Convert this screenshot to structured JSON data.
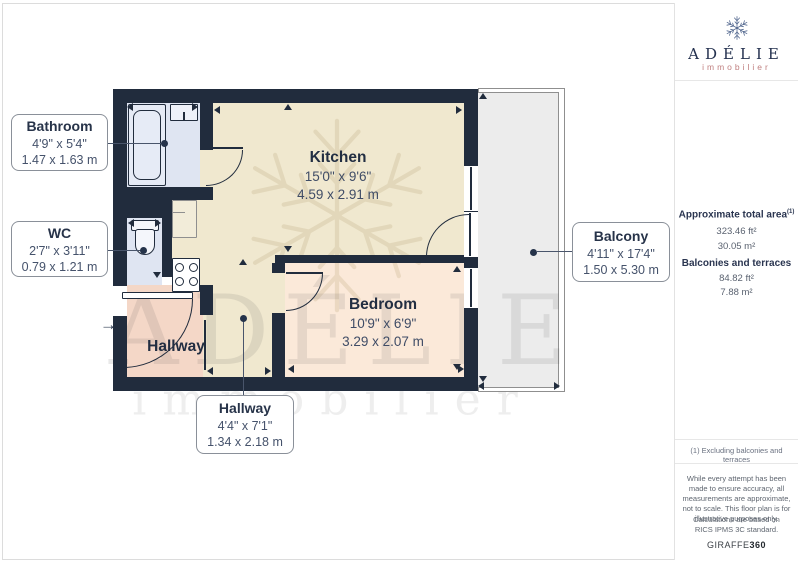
{
  "branding": {
    "name": "ADÉLIE",
    "tagline": "immobilier"
  },
  "sidebar": {
    "areas": {
      "title": "Approximate total area",
      "sup": "(1)",
      "values": [
        "323.46 ft²",
        "30.05 m²"
      ],
      "subtitle": "Balconies and terraces",
      "sub_values": [
        "84.82 ft²",
        "7.88 m²"
      ]
    },
    "footnote": "(1) Excluding balconies and terraces",
    "disclaimer1": "While every attempt has been made to ensure accuracy, all measurements are approximate, not to scale. This floor plan is for illustrative purposes only.",
    "disclaimer2": "Calculations are based on RICS IPMS 3C standard.",
    "brand_left": "GIRAFFE",
    "brand_right": "360"
  },
  "plan": {
    "watermark": {
      "title": "ADÉLIE",
      "subtitle": "immobilier"
    },
    "entry_arrow": {
      "glyph": "→",
      "x": 100,
      "y": 316
    },
    "colors": {
      "ink": "#212c3d",
      "kitchen": "#f0e8cf",
      "bedroom": "#fbe9d9",
      "hallway": "#f4d7c7",
      "bath": "#dfe5f2",
      "balcony": "#ececec",
      "leader": "#49556b"
    },
    "balcony": {
      "x": 478,
      "y": 88,
      "w": 87,
      "h": 304,
      "inset": 4
    },
    "floors": [
      {
        "id": "bathroom",
        "x": 127,
        "y": 103,
        "w": 73,
        "h": 84,
        "c": "bath"
      },
      {
        "id": "wc",
        "x": 127,
        "y": 218,
        "w": 35,
        "h": 67,
        "c": "bath"
      },
      {
        "id": "kitchen-main",
        "x": 213,
        "y": 103,
        "w": 251,
        "h": 152,
        "c": "kitchen"
      },
      {
        "id": "kitchen-side",
        "x": 172,
        "y": 200,
        "w": 41,
        "h": 93,
        "c": "kitchen"
      },
      {
        "id": "corridor",
        "x": 203,
        "y": 255,
        "w": 72,
        "h": 122,
        "c": "kitchen"
      },
      {
        "id": "hallway",
        "x": 127,
        "y": 285,
        "w": 76,
        "h": 92,
        "c": "hallway"
      },
      {
        "id": "bedroom",
        "x": 285,
        "y": 263,
        "w": 179,
        "h": 114,
        "c": "bedroom"
      }
    ],
    "walls": [
      [
        113,
        89,
        365,
        14
      ],
      [
        113,
        89,
        14,
        302
      ],
      [
        113,
        377,
        365,
        14
      ],
      [
        464,
        89,
        14,
        302
      ],
      [
        200,
        103,
        13,
        47
      ],
      [
        113,
        187,
        100,
        13
      ],
      [
        113,
        200,
        59,
        18
      ],
      [
        162,
        218,
        10,
        59
      ],
      [
        200,
        285,
        13,
        30
      ],
      [
        275,
        255,
        189,
        8
      ],
      [
        272,
        263,
        13,
        114
      ]
    ],
    "gaps": [
      {
        "id": "entry-opening",
        "x": 113,
        "y": 286,
        "w": 14,
        "h": 30,
        "c": "#ffffff"
      },
      {
        "id": "bathroom-door-opening",
        "x": 200,
        "y": 150,
        "w": 13,
        "h": 37,
        "c": "kitchen"
      },
      {
        "id": "bedroom-door-opening",
        "x": 272,
        "y": 273,
        "w": 13,
        "h": 40,
        "c": "kitchen"
      },
      {
        "id": "kitchen-window",
        "x": 464,
        "y": 166,
        "w": 14,
        "h": 45,
        "c": "#ffffff"
      },
      {
        "id": "balcony-door-opening",
        "x": 464,
        "y": 212,
        "w": 14,
        "h": 45,
        "c": "#ffffff"
      },
      {
        "id": "bedroom-window",
        "x": 464,
        "y": 268,
        "w": 14,
        "h": 40,
        "c": "#ffffff"
      }
    ],
    "fixtures": [
      {
        "id": "cupboard",
        "x": 172,
        "y": 200,
        "w": 25,
        "h": 38,
        "f": "#f2ecd9",
        "b": "#8f8f8f",
        "bw": 1,
        "r": "1px"
      },
      {
        "id": "bathtub",
        "x": 128,
        "y": 104,
        "w": 38,
        "h": 82,
        "f": "#e6ebf6",
        "b": "ink",
        "bw": 1.5,
        "r": "2px"
      },
      {
        "id": "bathtub-inner",
        "x": 133,
        "y": 110,
        "w": 28,
        "h": 70,
        "f": "transparent",
        "b": "ink",
        "bw": 1,
        "r": "8px"
      },
      {
        "id": "bathroom-sink",
        "x": 170,
        "y": 104,
        "w": 28,
        "h": 17,
        "f": "#eef1f9",
        "b": "ink",
        "bw": 1.2,
        "r": "1px"
      },
      {
        "id": "stove",
        "x": 172,
        "y": 258,
        "w": 28,
        "h": 34,
        "f": "#ffffff",
        "b": "ink",
        "bw": 1.4,
        "r": "1px"
      },
      {
        "id": "toilet-tank",
        "x": 131,
        "y": 220,
        "w": 28,
        "h": 11,
        "f": "#f4f6fb",
        "b": "ink",
        "bw": 1.2,
        "r": "2px"
      },
      {
        "id": "toilet-bowl",
        "x": 135,
        "y": 229,
        "w": 20,
        "h": 26,
        "f": "#f4f6fb",
        "b": "ink",
        "bw": 1.2,
        "r": "3px 3px 10px 10px"
      },
      {
        "id": "entry-door-leaf",
        "x": 122,
        "y": 292,
        "w": 71,
        "h": 7,
        "f": "#ffffff",
        "b": "ink",
        "bw": 1.2,
        "r": "1px"
      }
    ],
    "burners": [
      {
        "cx": 179,
        "cy": 267,
        "r": 4.5
      },
      {
        "cx": 193,
        "cy": 267,
        "r": 4.5
      },
      {
        "cx": 179,
        "cy": 281,
        "r": 4.5
      },
      {
        "cx": 193,
        "cy": 281,
        "r": 4.5
      }
    ],
    "lines": [
      {
        "id": "bathroom-door-leaf",
        "x": 206,
        "y": 147,
        "w": 37,
        "h": 2
      },
      {
        "id": "bedroom-door-leaf",
        "x": 286,
        "y": 272,
        "w": 37,
        "h": 2
      },
      {
        "id": "hallway-door-leaf",
        "x": 204,
        "y": 320,
        "w": 2,
        "h": 50
      },
      {
        "id": "balcony-door-leaf",
        "x": 469,
        "y": 213,
        "w": 2,
        "h": 43
      },
      {
        "id": "kitchen-window-frame",
        "x": 470,
        "y": 167,
        "w": 1.5,
        "h": 43
      },
      {
        "id": "bedroom-window-frame",
        "x": 470,
        "y": 269,
        "w": 1.5,
        "h": 38
      },
      {
        "id": "sink-tap",
        "x": 183,
        "y": 112,
        "w": 1.5,
        "h": 9
      },
      {
        "id": "cupboard-shelf",
        "x": 172,
        "y": 212,
        "w": 13,
        "h": 1,
        "c": "#8f8f8f"
      }
    ],
    "arcs": [
      {
        "id": "bathroom-door-swing",
        "x": 206,
        "y": 150,
        "w": 37,
        "h": 36,
        "corner": "br"
      },
      {
        "id": "bedroom-door-swing",
        "x": 286,
        "y": 273,
        "w": 37,
        "h": 38,
        "corner": "br"
      },
      {
        "id": "balcony-door-swing",
        "x": 426,
        "y": 214,
        "w": 43,
        "h": 43,
        "corner": "tl"
      },
      {
        "id": "entry-door-swing",
        "x": 123,
        "y": 299,
        "w": 70,
        "h": 69,
        "corner": "br"
      }
    ],
    "dots": [
      [
        164,
        143
      ],
      [
        143,
        250
      ],
      [
        533,
        252
      ],
      [
        243,
        318
      ]
    ],
    "leaders": [
      [
        108,
        143,
        56,
        1
      ],
      [
        108,
        250,
        35,
        1
      ],
      [
        537,
        251,
        35,
        1
      ],
      [
        243,
        318,
        1,
        77
      ]
    ],
    "arrows": [
      [
        130,
        107,
        "left"
      ],
      [
        195,
        107,
        "right"
      ],
      [
        217,
        110,
        "left"
      ],
      [
        459,
        110,
        "right"
      ],
      [
        288,
        107,
        "up"
      ],
      [
        288,
        249,
        "down"
      ],
      [
        131,
        223,
        "left"
      ],
      [
        158,
        223,
        "right"
      ],
      [
        157,
        275,
        "down"
      ],
      [
        210,
        371,
        "left"
      ],
      [
        268,
        371,
        "right"
      ],
      [
        243,
        262,
        "up"
      ],
      [
        291,
        369,
        "left"
      ],
      [
        461,
        369,
        "right"
      ],
      [
        457,
        269,
        "up"
      ],
      [
        457,
        367,
        "down"
      ],
      [
        483,
        96,
        "up"
      ],
      [
        483,
        379,
        "down"
      ],
      [
        481,
        386,
        "left"
      ],
      [
        557,
        386,
        "right"
      ]
    ],
    "label_boxes": [
      {
        "id": "bathroom",
        "x": 11,
        "y": 114,
        "w": 97,
        "h": 57,
        "name": "Bathroom",
        "ft": "4'9\" x 5'4\"",
        "m": "1.47 x 1.63 m"
      },
      {
        "id": "wc",
        "x": 11,
        "y": 221,
        "w": 97,
        "h": 56,
        "name": "WC",
        "ft": "2'7\" x 3'11\"",
        "m": "0.79 x 1.21 m"
      },
      {
        "id": "balcony",
        "x": 572,
        "y": 222,
        "w": 98,
        "h": 60,
        "name": "Balcony",
        "ft": "4'11\" x 17'4\"",
        "m": "1.50 x 5.30 m"
      },
      {
        "id": "hallway",
        "x": 196,
        "y": 395,
        "w": 98,
        "h": 59,
        "name": "Hallway",
        "ft": "4'4\" x 7'1\"",
        "m": "1.34 x 2.18 m"
      }
    ],
    "room_labels": [
      {
        "id": "kitchen",
        "x": 338,
        "y": 148,
        "name": "Kitchen",
        "ft": "15'0\" x 9'6\"",
        "m": "4.59 x 2.91 m"
      },
      {
        "id": "bedroom",
        "x": 383,
        "y": 295,
        "name": "Bedroom",
        "ft": "10'9\" x 6'9\"",
        "m": "3.29 x 2.07 m"
      },
      {
        "id": "hallway-inline",
        "x": 176,
        "y": 337,
        "name": "Hallway",
        "ft": "",
        "m": ""
      }
    ]
  }
}
